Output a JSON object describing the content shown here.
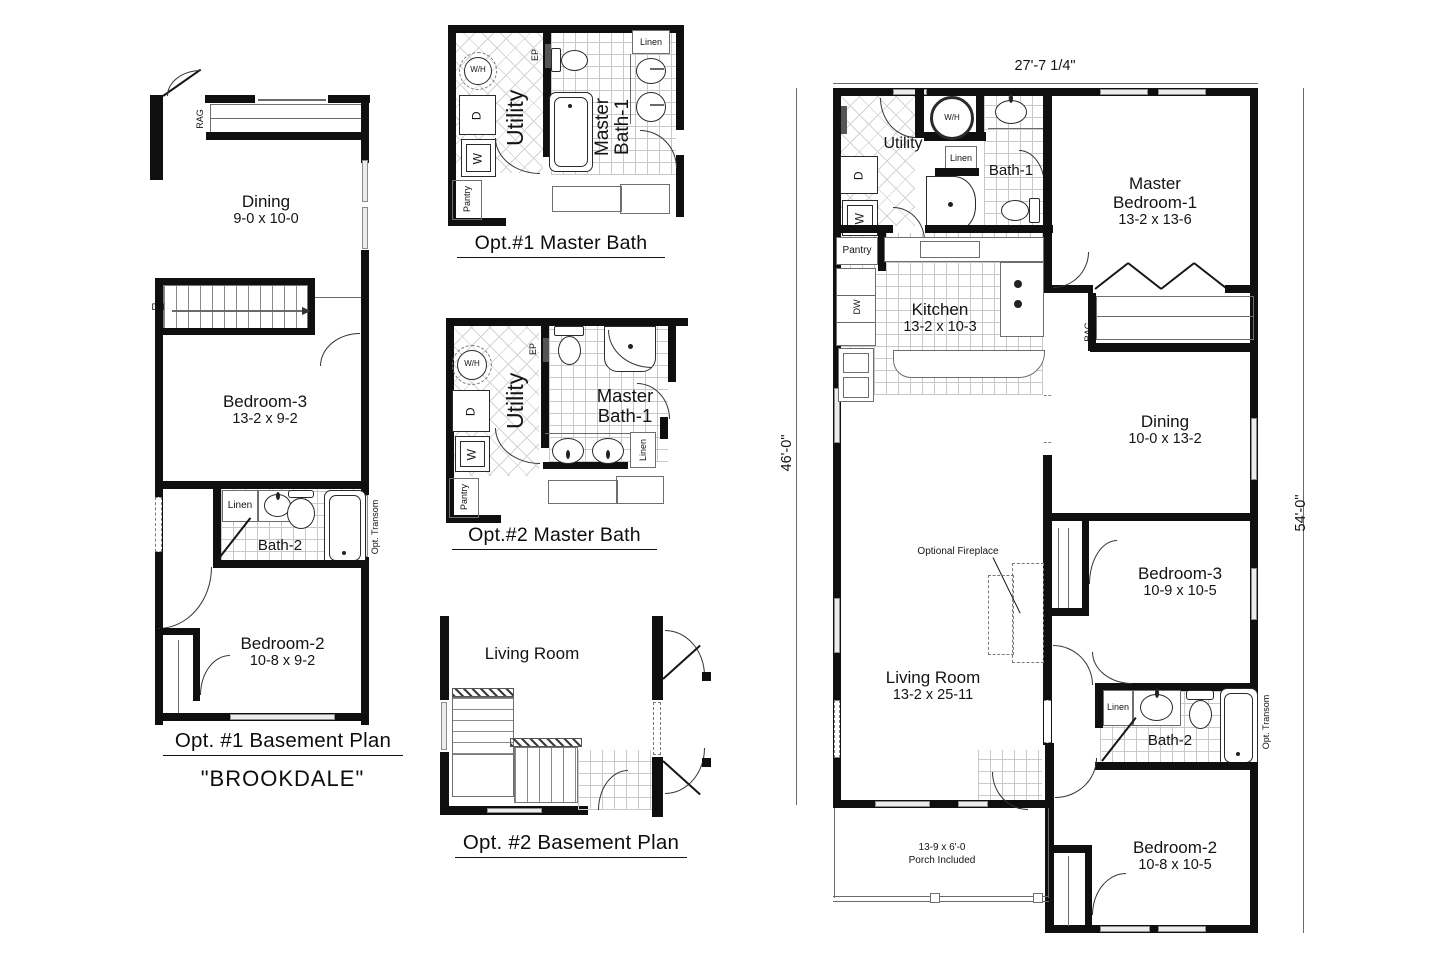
{
  "bp1": {
    "title": "Opt. #1 Basement Plan",
    "model": "\"BROOKDALE\"",
    "rag": "RAG",
    "dn": "DN",
    "linen": "Linen",
    "opt_transom": "Opt. Transom",
    "dining": {
      "name": "Dining",
      "dims": "9-0 x 10-0"
    },
    "bedroom3": {
      "name": "Bedroom-3",
      "dims": "13-2 x 9-2"
    },
    "bath2": {
      "name": "Bath-2"
    },
    "bedroom2": {
      "name": "Bedroom-2",
      "dims": "10-8 x 9-2"
    }
  },
  "mb1": {
    "title": "Opt.#1 Master Bath",
    "wh": "W/H",
    "d": "D",
    "w": "W",
    "ep": "EP",
    "pantry": "Pantry",
    "utility": "Utility",
    "linen": "Linen",
    "room_l1": "Master",
    "room_l2": "Bath-1"
  },
  "mb2": {
    "title": "Opt.#2 Master Bath",
    "wh": "W/H",
    "d": "D",
    "w": "W",
    "ep": "EP",
    "pantry": "Pantry",
    "utility": "Utility",
    "linen": "Linen",
    "room_l1": "Master",
    "room_l2": "Bath-1"
  },
  "bp2": {
    "title": "Opt. #2 Basement Plan",
    "living": "Living Room"
  },
  "main": {
    "dim_width": "27'-7 1/4\"",
    "dim_left": "46'-0\"",
    "dim_right": "54'-0\"",
    "ep": "EP",
    "utility": "Utility",
    "wh": "W/H",
    "linen_bath1": "Linen",
    "bath1": "Bath-1",
    "master": {
      "l1": "Master",
      "l2": "Bedroom-1",
      "dims": "13-2 x 13-6"
    },
    "pantry": "Pantry",
    "dw": "DW",
    "d": "D",
    "w": "W",
    "kitchen": {
      "name": "Kitchen",
      "dims": "13-2 x 10-3"
    },
    "rag": "RAG",
    "dining": {
      "name": "Dining",
      "dims": "10-0 x 13-2"
    },
    "fireplace": "Optional Fireplace",
    "bedroom3": {
      "name": "Bedroom-3",
      "dims": "10-9 x 10-5"
    },
    "living": {
      "name": "Living Room",
      "dims": "13-2 x 25-11"
    },
    "linen_bath2": "Linen",
    "bath2": "Bath-2",
    "opt_transom": "Opt. Transom",
    "bedroom2": {
      "name": "Bedroom-2",
      "dims": "10-8 x 10-5"
    },
    "porch_l1": "13-9 x 6'-0",
    "porch_l2": "Porch Included"
  }
}
